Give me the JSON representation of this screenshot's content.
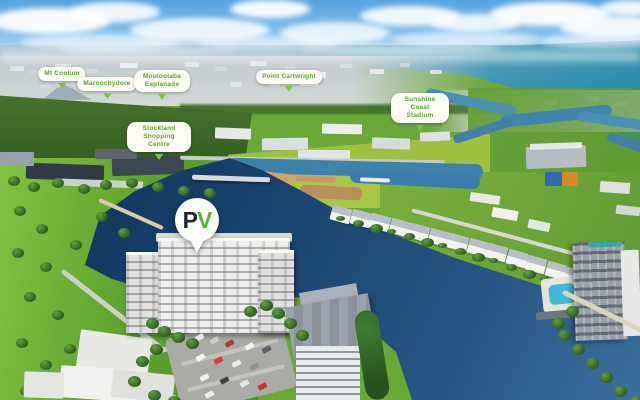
{
  "image_type": "aerial-photograph-with-location-callouts",
  "location_labels": [
    {
      "text": "Mt Coolum"
    },
    {
      "text": "Maroochydore"
    },
    {
      "text": "Mooloolaba Esplanade"
    },
    {
      "text": "Point Cartwright"
    },
    {
      "text": "Sunshine Coast Stadium"
    },
    {
      "text": "Stockland Shopping Centre"
    }
  ],
  "brand_pin": {
    "letter_p": "P",
    "letter_v": "V",
    "p_color": "#1e2533",
    "v_color": "#54b42c"
  },
  "palette": {
    "label_text_green": "#58a32d",
    "label_pointer_green": "#7cc242",
    "lake_navy": "#16406b",
    "ocean_teal": "#2c8cab",
    "park_green": "#5fa32e"
  }
}
